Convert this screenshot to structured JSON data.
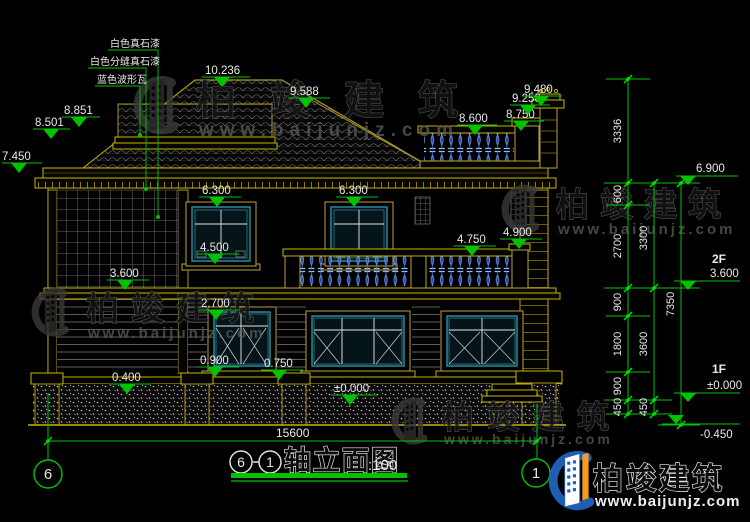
{
  "materials": {
    "l1": "白色真石漆",
    "l2": "白色分缝真石漆",
    "l3": "蓝色波形瓦"
  },
  "marks": {
    "m10236": "10.236",
    "m9588": "9.588",
    "m8851": "8.851",
    "m8501": "8.501",
    "m7450": "7.450",
    "m8600": "8.600",
    "m8750": "8.750",
    "m9250": "9.250",
    "m9480": "9.480",
    "m6300a": "6.300",
    "m6300b": "6.300",
    "m4500": "4.500",
    "m4750": "4.750",
    "m4900": "4.900",
    "m3600": "3.600",
    "m2700": "2.700",
    "m0900": "0.900",
    "m0750": "0.750",
    "m0400": "0.400",
    "m0000": "±0.000",
    "m6900": "6.900",
    "f2": "2F",
    "f2elev": "3.600",
    "f1": "1F",
    "f1elev": "±0.000",
    "mneg": "-0.450"
  },
  "dims": {
    "v3336": "3336",
    "v600": "600",
    "v2700": "2700",
    "v3300": "3300",
    "v900a": "900",
    "v1800": "1800",
    "v3600": "3600",
    "v900b": "900",
    "v450a": "450",
    "v450b": "450",
    "v7350": "7350",
    "total": "15600"
  },
  "axis": {
    "left": "6",
    "right": "1"
  },
  "title": {
    "s": "6",
    "e": "1",
    "name": "轴立面图",
    "scale": ":100"
  },
  "watermark": {
    "name": "柏竣建筑",
    "url": "www.baijunjz.com"
  },
  "brand": {
    "name": "柏竣建筑",
    "url": "www.baijunjz.com"
  },
  "colors": {
    "annotation_green": "#00c300",
    "outline_yellow": "#c8b400",
    "frame_teal": "#2e8fa3",
    "baluster_blue": "#3a62d8",
    "logo_blue": "#1e5fb4",
    "logo_orange": "#f59a23"
  }
}
